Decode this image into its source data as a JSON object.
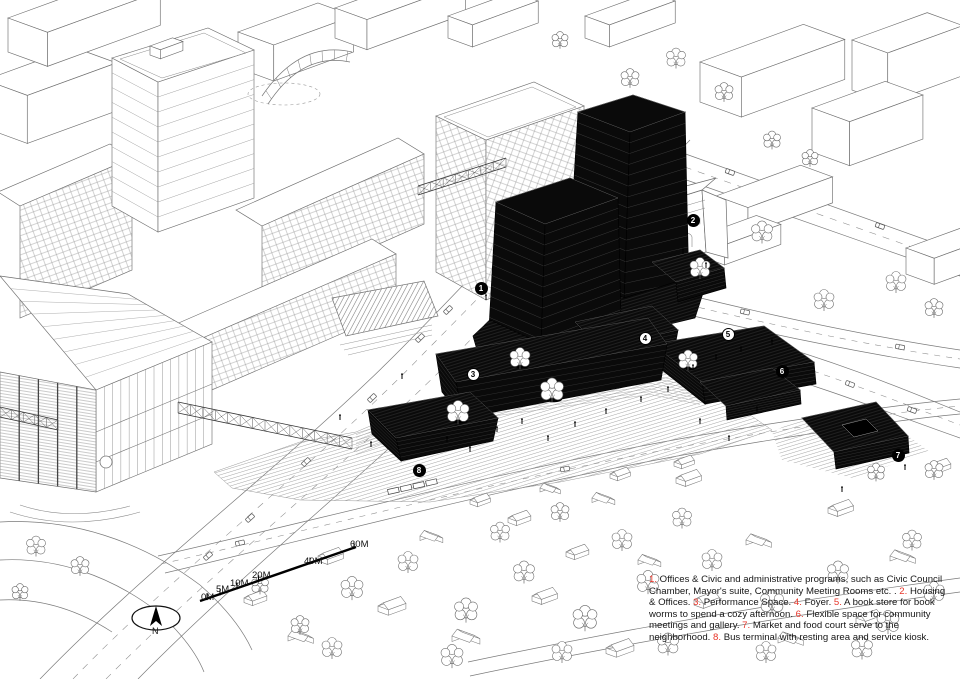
{
  "page": {
    "width": 960,
    "height": 679,
    "background": "#ffffff"
  },
  "colors": {
    "ink": "#161616",
    "context_line": "#6e6e6e",
    "project_black": "#0a0a0a",
    "accent_red": "#e8362a"
  },
  "north_arrow": {
    "label": "N"
  },
  "scale_bar": {
    "labels": [
      {
        "text": "0M",
        "x": 201,
        "y": 592
      },
      {
        "text": "5M",
        "x": 216,
        "y": 584
      },
      {
        "text": "10M",
        "x": 230,
        "y": 578
      },
      {
        "text": "20M",
        "x": 252,
        "y": 570
      },
      {
        "text": "40M",
        "x": 304,
        "y": 556
      },
      {
        "text": "60M",
        "x": 350,
        "y": 539
      }
    ]
  },
  "callouts": [
    {
      "num": "1",
      "x": 481,
      "y": 288,
      "variant": "dark"
    },
    {
      "num": "2",
      "x": 693,
      "y": 220,
      "variant": "dark"
    },
    {
      "num": "3",
      "x": 473,
      "y": 374,
      "variant": "light"
    },
    {
      "num": "4",
      "x": 645,
      "y": 338,
      "variant": "light"
    },
    {
      "num": "5",
      "x": 728,
      "y": 334,
      "variant": "light"
    },
    {
      "num": "6",
      "x": 782,
      "y": 371,
      "variant": "dark"
    },
    {
      "num": "7",
      "x": 898,
      "y": 455,
      "variant": "dark"
    },
    {
      "num": "8",
      "x": 419,
      "y": 470,
      "variant": "dark"
    }
  ],
  "legend": {
    "items": [
      {
        "num": "1",
        "text": "Offices & Civic and administrative programs, such as Civic Council Chamber, Mayor's suite, Community Meeting Rooms etc. ."
      },
      {
        "num": "2",
        "text": "Housing & Offices."
      },
      {
        "num": "3",
        "text": "Performance Space."
      },
      {
        "num": "4",
        "text": "Foyer."
      },
      {
        "num": "5",
        "text": "A book store for book worms to spend a cozy afternoon."
      },
      {
        "num": "6",
        "text": "Flexible space for community meetings and gallery."
      },
      {
        "num": "7",
        "text": "Market and food court serve to the neighborhood."
      },
      {
        "num": "8",
        "text": "Bus terminal with resting area and service kiosk."
      }
    ]
  }
}
